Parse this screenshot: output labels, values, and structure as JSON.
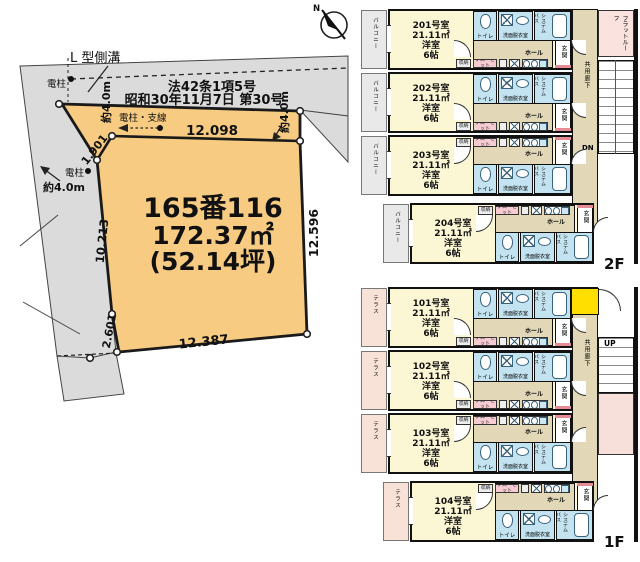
{
  "site_plan": {
    "compass": "N",
    "gutter_label": "L 型側溝",
    "pole_label": "電柱",
    "pole_wire_label": "電柱・支線",
    "road_note_line1": "法42条1項5号",
    "road_note_line2": "昭和30年11月7日 第30号",
    "road_width": "約4.0m",
    "lot_number": "165番116",
    "area_m2": "172.37㎡",
    "area_tsubo": "(52.14坪)",
    "dim_top": "12.098",
    "dim_diagonal": "1.901",
    "dim_left": "10.213",
    "dim_left_lower": "2.601",
    "dim_bottom": "12.387",
    "dim_right": "12.596"
  },
  "floor_plans": {
    "unit_common": {
      "area": "21.11㎡",
      "room_type": "洋室",
      "room_size": "6帖",
      "toilet": "トイレ",
      "washroom": "洗面脱衣室",
      "bath_line1": "システム",
      "bath_line2": "バス",
      "hall": "ホール",
      "entrance": "玄関",
      "closet": "クローゼット",
      "storage": "収納",
      "corridor": "共用廊下"
    },
    "f2": {
      "floor_label": "2F",
      "balcony_label": "バルコニー",
      "flat_roof_line1": "フラット",
      "flat_roof_line2": "ルーフ",
      "stair_label": "DN",
      "units": [
        {
          "name": "201号室"
        },
        {
          "name": "202号室"
        },
        {
          "name": "203号室"
        },
        {
          "name": "204号室"
        }
      ]
    },
    "f1": {
      "floor_label": "1F",
      "balcony_label": "テラス",
      "stair_label": "UP",
      "units": [
        {
          "name": "101号室"
        },
        {
          "name": "102号室"
        },
        {
          "name": "103号室"
        },
        {
          "name": "104号室"
        }
      ]
    }
  },
  "colors": {
    "lot_fill": "#F7CB81",
    "road_fill": "#DBDBDB",
    "room_fill": "#FBF6D3",
    "wet_fill": "#C3E3F0",
    "hall_fill": "#E2D8B8",
    "terrace_fill": "#F8E2D7",
    "flat_roof_fill": "#FAE3DE",
    "entrance_yellow": "#FFDF00",
    "closet_pink": "#F6CBD2",
    "wall": "#111111"
  }
}
